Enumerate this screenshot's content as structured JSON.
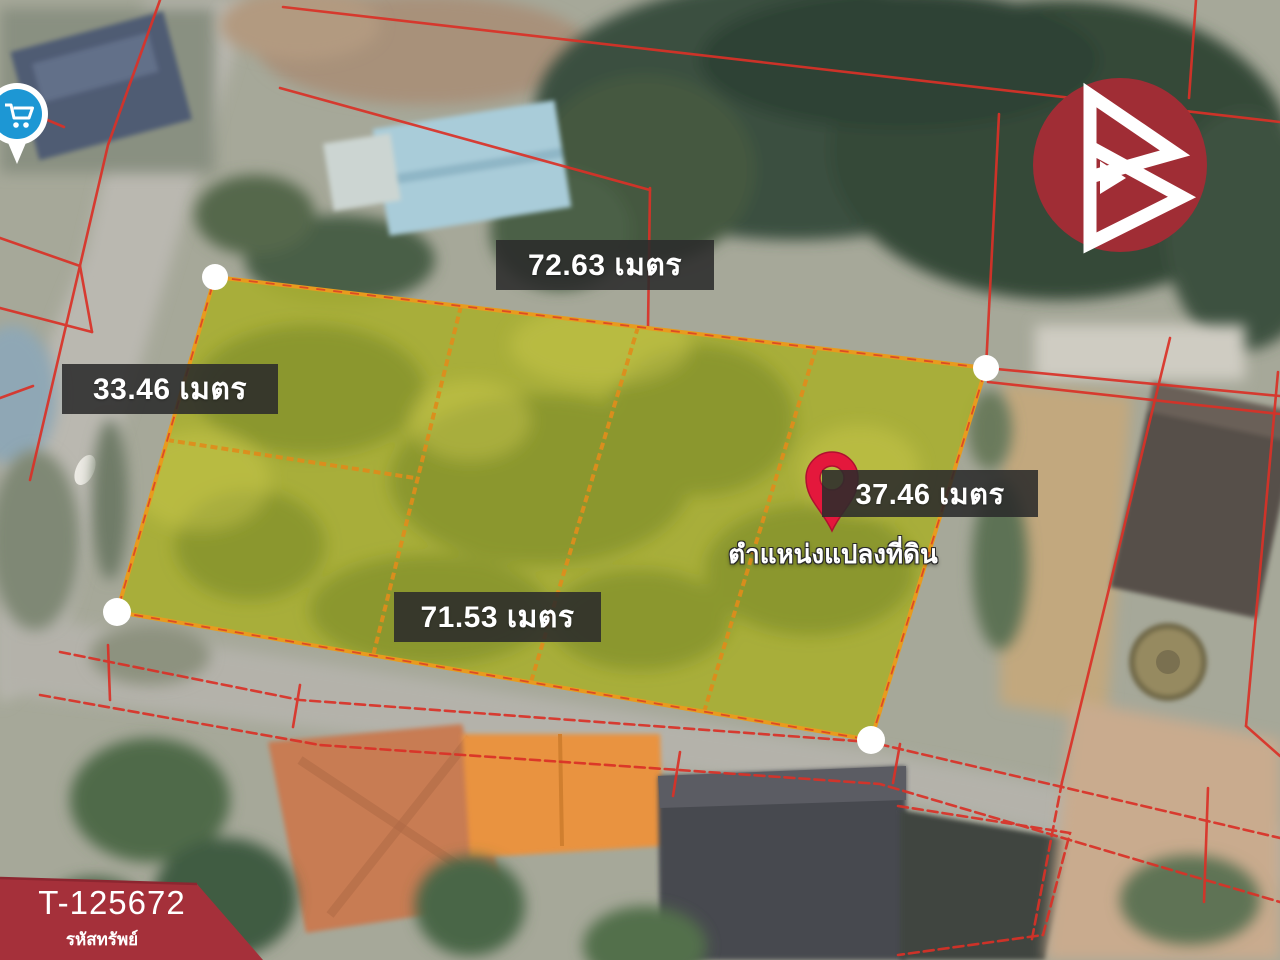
{
  "colors": {
    "boundary_red": "#da3127",
    "plot_fill": "#a8ae33",
    "plot_border": "#e89b1e",
    "plot_divider": "#dd8d1c",
    "label_bg": "rgba(43,43,43,0.88)",
    "label_text": "#ffffff",
    "pin_red": "#e4183c",
    "logo_red": "#a02d35",
    "ribbon_red": "#a5303a",
    "marker_blue": "#1d97d4",
    "vertex_white": "#ffffff"
  },
  "annotations": {
    "measurements": [
      {
        "id": "top",
        "text": "72.63 เมตร"
      },
      {
        "id": "left",
        "text": "33.46 เมตร"
      },
      {
        "id": "right",
        "text": "37.46 เมตร"
      },
      {
        "id": "bottom",
        "text": "71.53 เมตร"
      }
    ],
    "pin_caption": "ตำแหน่งแปลงที่ดิน"
  },
  "property": {
    "code": "T-125672",
    "code_caption": "รหัสทรัพย์"
  },
  "icons": {
    "logo": "brand-logo",
    "pin": "location-pin-icon",
    "store": "store-marker-icon"
  }
}
